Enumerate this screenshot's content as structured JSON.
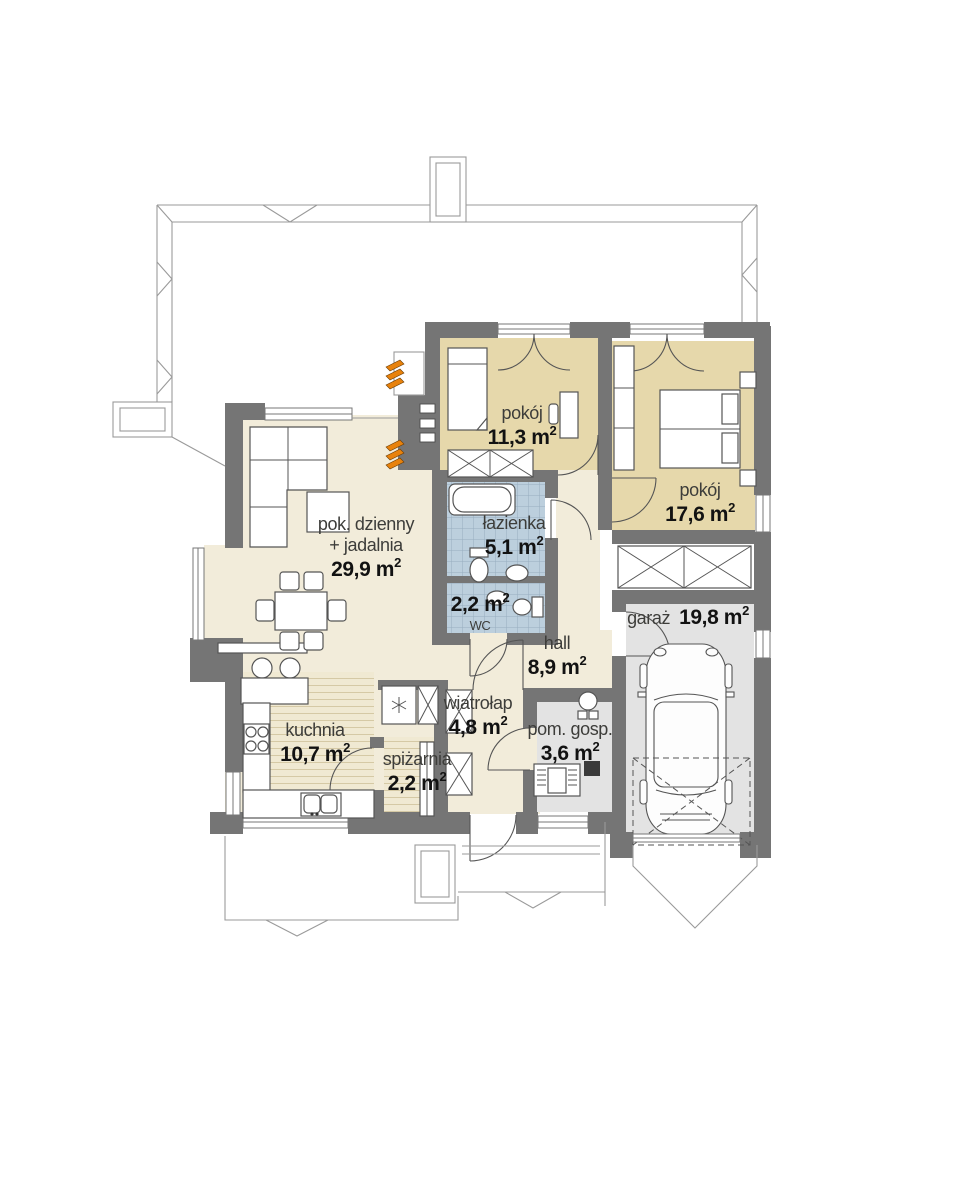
{
  "palette": {
    "wall": "#757575",
    "floor_cream": "#f2ecda",
    "floor_tan": "#e6d8ab",
    "tile_blue": "#bccfdd",
    "floor_gray": "#e3e3e3",
    "accent_orange": "#e8820c",
    "line": "#555555"
  },
  "units": {
    "base": " m",
    "sup": "2"
  },
  "rooms": [
    {
      "id": "living",
      "name": "pok. dzienny",
      "name2": "+ jadalnia",
      "area": "29,9"
    },
    {
      "id": "bedroom-small",
      "name": "pokój",
      "area": "11,3"
    },
    {
      "id": "bedroom-large",
      "name": "pokój",
      "area": "17,6"
    },
    {
      "id": "bathroom",
      "name": "łazienka",
      "area": "5,1"
    },
    {
      "id": "wc",
      "name": "WC",
      "area": "2,2"
    },
    {
      "id": "hall",
      "name": "hall",
      "area": "8,9"
    },
    {
      "id": "garage",
      "name": "garaż",
      "area": "19,8"
    },
    {
      "id": "kitchen",
      "name": "kuchnia",
      "area": "10,7"
    },
    {
      "id": "pantry",
      "name": "spiżarnia",
      "area": "2,2"
    },
    {
      "id": "vestibule",
      "name": "wiatrołap",
      "area": "4,8"
    },
    {
      "id": "utility",
      "name": "pom. gosp.",
      "area": "3,6"
    }
  ]
}
